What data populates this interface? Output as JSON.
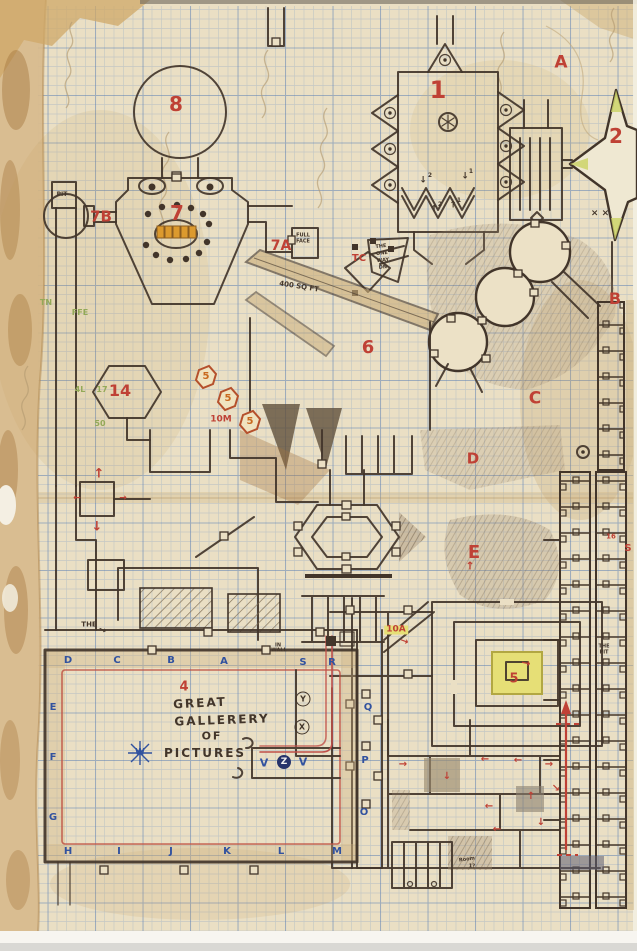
{
  "meta": {
    "type": "scanned hand-drawn dungeon map",
    "media": "pencil and ink on blue graph paper, aged and torn edges",
    "visible_room_numbers": [
      "1",
      "2",
      "4",
      "5",
      "6",
      "7",
      "7A",
      "7B",
      "8",
      "14",
      "10M",
      "10A",
      "TC"
    ],
    "visible_area_letters": [
      "A",
      "B",
      "C",
      "D",
      "E"
    ],
    "gallery_title": "GREAT GALLERERY OF PICTURES"
  },
  "colors": {
    "paper": "#eadfc4",
    "ink": "#42352a",
    "red": "#bf4135",
    "orange": "#c96a1f",
    "blue": "#31529f",
    "green": "#93a958",
    "yellow": "#e6df76",
    "tan": "#c9ad79",
    "white": "#f2f2f2",
    "grid": "#9db6d4"
  },
  "labels": [
    {
      "t": "8",
      "x": 176,
      "y": 104,
      "c": "red",
      "s": 20
    },
    {
      "t": "7",
      "x": 177,
      "y": 213,
      "c": "red",
      "s": 20
    },
    {
      "t": "7B",
      "x": 101,
      "y": 217,
      "c": "red",
      "s": 15
    },
    {
      "t": "7A",
      "x": 281,
      "y": 246,
      "c": "red",
      "s": 14
    },
    {
      "t": "14",
      "x": 120,
      "y": 391,
      "c": "red",
      "s": 16
    },
    {
      "t": "1",
      "x": 438,
      "y": 90,
      "c": "red",
      "s": 24
    },
    {
      "t": "2",
      "x": 616,
      "y": 136,
      "c": "red",
      "s": 20
    },
    {
      "t": "A",
      "x": 561,
      "y": 63,
      "c": "red",
      "s": 17
    },
    {
      "t": "B",
      "x": 615,
      "y": 299,
      "c": "red",
      "s": 16
    },
    {
      "t": "C",
      "x": 535,
      "y": 399,
      "c": "red",
      "s": 17
    },
    {
      "t": "D",
      "x": 473,
      "y": 459,
      "c": "red",
      "s": 15
    },
    {
      "t": "E",
      "x": 474,
      "y": 553,
      "c": "red",
      "s": 18
    },
    {
      "t": "6",
      "x": 368,
      "y": 348,
      "c": "red",
      "s": 18
    },
    {
      "t": "TC",
      "x": 359,
      "y": 259,
      "c": "red",
      "s": 10
    },
    {
      "t": "10M",
      "x": 221,
      "y": 420,
      "c": "red",
      "s": 9
    },
    {
      "t": "10A",
      "x": 396,
      "y": 630,
      "c": "red",
      "s": 9,
      "cl": "hl"
    },
    {
      "t": "5",
      "x": 206,
      "y": 377,
      "c": "orange",
      "s": 10
    },
    {
      "t": "5",
      "x": 228,
      "y": 399,
      "c": "orange",
      "s": 10
    },
    {
      "t": "5",
      "x": 250,
      "y": 422,
      "c": "orange",
      "s": 10
    },
    {
      "t": "5",
      "x": 514,
      "y": 679,
      "c": "red",
      "s": 13
    },
    {
      "t": "→",
      "x": 526,
      "y": 663,
      "c": "red",
      "s": 11,
      "r": 12
    },
    {
      "t": "4",
      "x": 184,
      "y": 687,
      "c": "red",
      "s": 13
    },
    {
      "t": "↑",
      "x": 99,
      "y": 474,
      "c": "red",
      "s": 13
    },
    {
      "t": "↓",
      "x": 97,
      "y": 527,
      "c": "red",
      "s": 13
    },
    {
      "t": "→",
      "x": 123,
      "y": 499,
      "c": "red",
      "s": 9
    },
    {
      "t": "←",
      "x": 77,
      "y": 499,
      "c": "red",
      "s": 9
    },
    {
      "t": "→",
      "x": 404,
      "y": 642,
      "c": "red",
      "s": 10,
      "r": 20
    },
    {
      "t": "↑",
      "x": 470,
      "y": 566,
      "c": "red",
      "s": 11
    },
    {
      "t": "→",
      "x": 403,
      "y": 765,
      "c": "red",
      "s": 10
    },
    {
      "t": "↓",
      "x": 447,
      "y": 777,
      "c": "red",
      "s": 10
    },
    {
      "t": "←",
      "x": 485,
      "y": 760,
      "c": "red",
      "s": 10
    },
    {
      "t": "←",
      "x": 518,
      "y": 761,
      "c": "red",
      "s": 10
    },
    {
      "t": "→",
      "x": 549,
      "y": 765,
      "c": "red",
      "s": 10
    },
    {
      "t": "↘",
      "x": 556,
      "y": 789,
      "c": "red",
      "s": 10
    },
    {
      "t": "↑",
      "x": 531,
      "y": 797,
      "c": "red",
      "s": 10
    },
    {
      "t": "←",
      "x": 489,
      "y": 807,
      "c": "red",
      "s": 10
    },
    {
      "t": "↓",
      "x": 541,
      "y": 823,
      "c": "red",
      "s": 10
    },
    {
      "t": "←",
      "x": 497,
      "y": 830,
      "c": "red",
      "s": 10
    },
    {
      "t": "S",
      "x": 628,
      "y": 549,
      "c": "red",
      "s": 10
    },
    {
      "t": "16",
      "x": 611,
      "y": 537,
      "c": "red",
      "s": 7
    },
    {
      "t": "× ×",
      "x": 600,
      "y": 214,
      "c": "ink",
      "s": 9
    },
    {
      "t": "D",
      "x": 68,
      "y": 661,
      "c": "blue",
      "s": 10
    },
    {
      "t": "C",
      "x": 117,
      "y": 661,
      "c": "blue",
      "s": 10
    },
    {
      "t": "B",
      "x": 171,
      "y": 661,
      "c": "blue",
      "s": 10
    },
    {
      "t": "A",
      "x": 224,
      "y": 662,
      "c": "blue",
      "s": 10
    },
    {
      "t": "S",
      "x": 303,
      "y": 663,
      "c": "blue",
      "s": 10
    },
    {
      "t": "R",
      "x": 332,
      "y": 663,
      "c": "blue",
      "s": 10
    },
    {
      "t": "E",
      "x": 53,
      "y": 708,
      "c": "blue",
      "s": 10
    },
    {
      "t": "F",
      "x": 53,
      "y": 758,
      "c": "blue",
      "s": 10
    },
    {
      "t": "G",
      "x": 53,
      "y": 818,
      "c": "blue",
      "s": 10
    },
    {
      "t": "H",
      "x": 68,
      "y": 852,
      "c": "blue",
      "s": 10
    },
    {
      "t": "I",
      "x": 119,
      "y": 852,
      "c": "blue",
      "s": 10
    },
    {
      "t": "J",
      "x": 171,
      "y": 852,
      "c": "blue",
      "s": 10
    },
    {
      "t": "K",
      "x": 227,
      "y": 852,
      "c": "blue",
      "s": 10
    },
    {
      "t": "L",
      "x": 281,
      "y": 852,
      "c": "blue",
      "s": 10
    },
    {
      "t": "M",
      "x": 337,
      "y": 852,
      "c": "blue",
      "s": 10
    },
    {
      "t": "Q",
      "x": 368,
      "y": 708,
      "c": "blue",
      "s": 10
    },
    {
      "t": "P",
      "x": 365,
      "y": 761,
      "c": "blue",
      "s": 10
    },
    {
      "t": "O",
      "x": 364,
      "y": 813,
      "c": "blue",
      "s": 10
    },
    {
      "t": "V",
      "x": 264,
      "y": 763,
      "c": "blue",
      "s": 11
    },
    {
      "t": "V",
      "x": 303,
      "y": 762,
      "c": "blue",
      "s": 11
    },
    {
      "t": "Z",
      "x": 284,
      "y": 762,
      "c": "white",
      "s": 9,
      "cl": "circled-fill"
    },
    {
      "t": "Y",
      "x": 303,
      "y": 699,
      "c": "ink",
      "s": 8,
      "cl": "circled"
    },
    {
      "t": "X",
      "x": 302,
      "y": 727,
      "c": "ink",
      "s": 8,
      "cl": "circled"
    },
    {
      "t": "W",
      "x": 140,
      "y": 753,
      "c": "blue",
      "s": 9
    },
    {
      "t": "TN",
      "x": 46,
      "y": 303,
      "c": "green",
      "s": 8
    },
    {
      "t": "FFE",
      "x": 80,
      "y": 313,
      "c": "green",
      "s": 8
    },
    {
      "t": "4L",
      "x": 80,
      "y": 390,
      "c": "green",
      "s": 8
    },
    {
      "t": "17",
      "x": 102,
      "y": 390,
      "c": "green",
      "s": 8
    },
    {
      "t": "50",
      "x": 100,
      "y": 424,
      "c": "green",
      "s": 8
    },
    {
      "t": "PIT",
      "x": 62,
      "y": 195,
      "c": "ink",
      "s": 6
    },
    {
      "t": "FULL",
      "x": 303,
      "y": 236,
      "c": "ink",
      "s": 5
    },
    {
      "t": "FACE",
      "x": 303,
      "y": 242,
      "c": "ink",
      "s": 5
    },
    {
      "t": "400 SQ FT",
      "x": 299,
      "y": 287,
      "c": "ink",
      "s": 7,
      "r": 9
    },
    {
      "t": "THE",
      "x": 381,
      "y": 247,
      "c": "ink",
      "s": 5,
      "r": -6
    },
    {
      "t": "ONE",
      "x": 382,
      "y": 254,
      "c": "ink",
      "s": 5,
      "r": -6
    },
    {
      "t": "WAY",
      "x": 383,
      "y": 261,
      "c": "ink",
      "s": 5,
      "r": -6
    },
    {
      "t": "DN",
      "x": 383,
      "y": 268,
      "c": "ink",
      "s": 5,
      "r": -6
    },
    {
      "t": "THE",
      "x": 89,
      "y": 625,
      "c": "ink",
      "s": 7
    },
    {
      "t": "→",
      "x": 102,
      "y": 631,
      "c": "ink",
      "s": 9,
      "r": 25
    },
    {
      "t": "IN",
      "x": 278,
      "y": 646,
      "c": "ink",
      "s": 5
    },
    {
      "t": "WALL",
      "x": 279,
      "y": 651,
      "c": "ink",
      "s": 5
    },
    {
      "t": "THE",
      "x": 604,
      "y": 647,
      "c": "ink",
      "s": 5
    },
    {
      "t": "PIT",
      "x": 604,
      "y": 653,
      "c": "ink",
      "s": 5
    },
    {
      "t": "Room",
      "x": 467,
      "y": 860,
      "c": "ink",
      "s": 5,
      "r": -8
    },
    {
      "t": "1?",
      "x": 472,
      "y": 867,
      "c": "ink",
      "s": 5
    },
    {
      "t": "↓",
      "x": 423,
      "y": 181,
      "c": "ink",
      "s": 9
    },
    {
      "t": "2",
      "x": 430,
      "y": 176,
      "c": "ink",
      "s": 6
    },
    {
      "t": "↓",
      "x": 465,
      "y": 177,
      "c": "ink",
      "s": 9
    },
    {
      "t": "1",
      "x": 471,
      "y": 172,
      "c": "ink",
      "s": 6
    },
    {
      "t": "↑",
      "x": 434,
      "y": 210,
      "c": "ink",
      "s": 9
    },
    {
      "t": "2",
      "x": 440,
      "y": 205,
      "c": "ink",
      "s": 6
    },
    {
      "t": "↑",
      "x": 453,
      "y": 206,
      "c": "ink",
      "s": 9
    },
    {
      "t": "1",
      "x": 459,
      "y": 201,
      "c": "ink",
      "s": 6
    },
    {
      "t": "GREAT",
      "x": 200,
      "y": 703,
      "c": "ink",
      "s": 12,
      "r": -3,
      "cl": "gal"
    },
    {
      "t": "GALLERERY",
      "x": 222,
      "y": 720,
      "c": "ink",
      "s": 12,
      "r": -2,
      "cl": "gal"
    },
    {
      "t": "OF",
      "x": 212,
      "y": 736,
      "c": "ink",
      "s": 11,
      "cl": "gal"
    },
    {
      "t": "PICTURES",
      "x": 205,
      "y": 753,
      "c": "ink",
      "s": 12,
      "cl": "gal"
    }
  ]
}
